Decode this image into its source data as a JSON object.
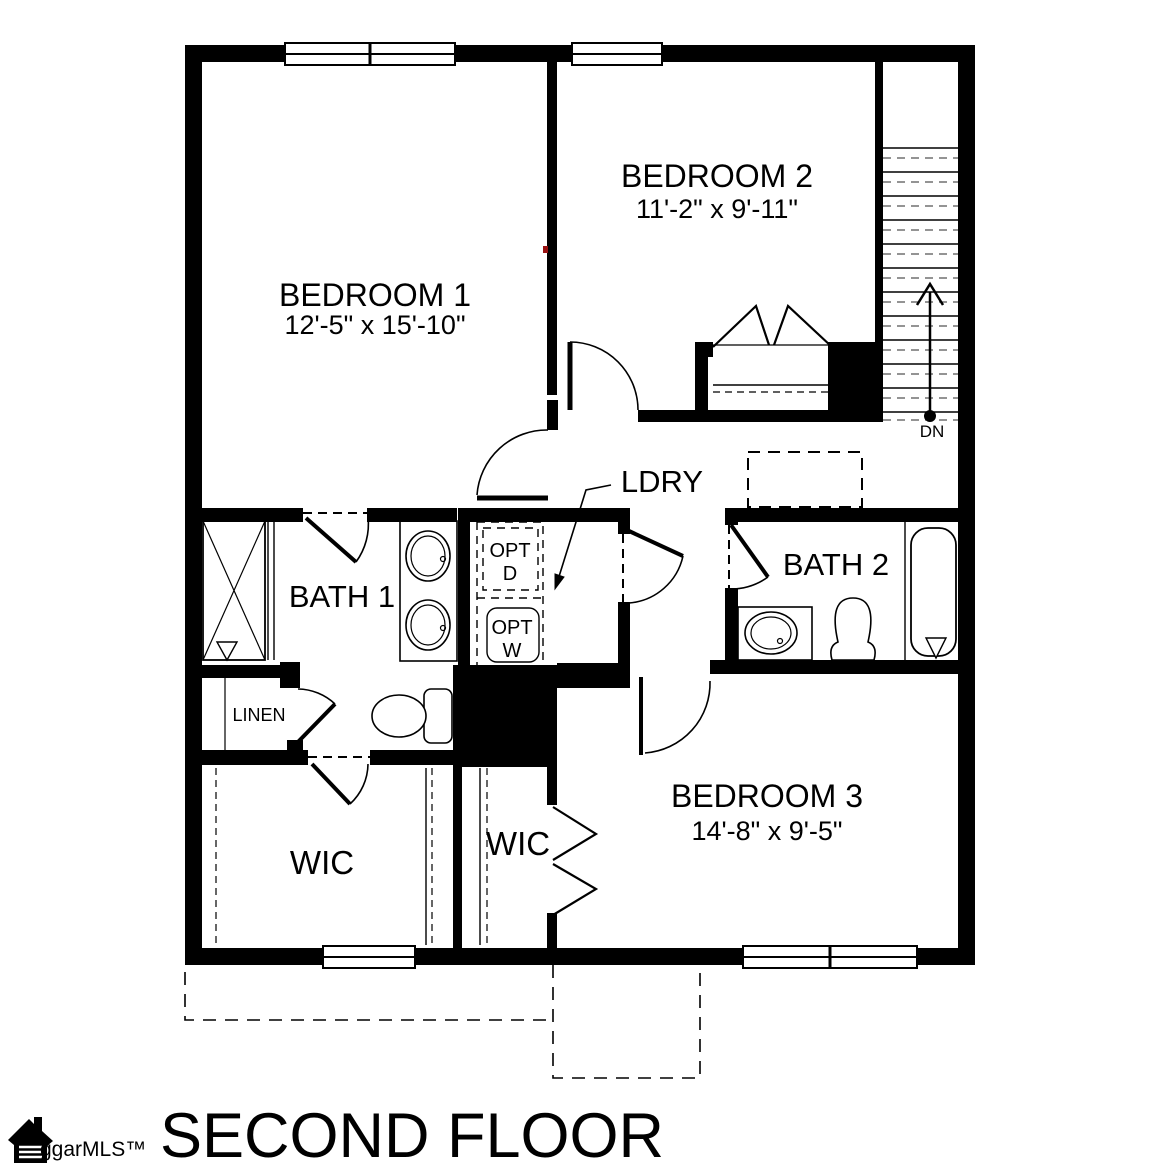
{
  "title": "SECOND FLOOR",
  "watermark": "ggarMLS™",
  "rooms": {
    "bedroom1": {
      "name": "BEDROOM 1",
      "dims": "12'-5\" x 15'-10\""
    },
    "bedroom2": {
      "name": "BEDROOM 2",
      "dims": "11'-2\" x 9'-11\""
    },
    "bedroom3": {
      "name": "BEDROOM 3",
      "dims": "14'-8\" x 9'-5\""
    },
    "bath1": {
      "name": "BATH 1"
    },
    "bath2": {
      "name": "BATH 2"
    },
    "laundry": {
      "name": "LDRY"
    },
    "linen": {
      "name": "LINEN"
    },
    "wic_left": {
      "name": "WIC"
    },
    "wic_right": {
      "name": "WIC"
    }
  },
  "annotations": {
    "stairs_down": "DN",
    "opt_dryer_line1": "OPT",
    "opt_dryer_line2": "D",
    "opt_washer_line1": "OPT",
    "opt_washer_line2": "W"
  },
  "colors": {
    "walls": "#000000",
    "background": "#ffffff",
    "marker": "#991111"
  }
}
